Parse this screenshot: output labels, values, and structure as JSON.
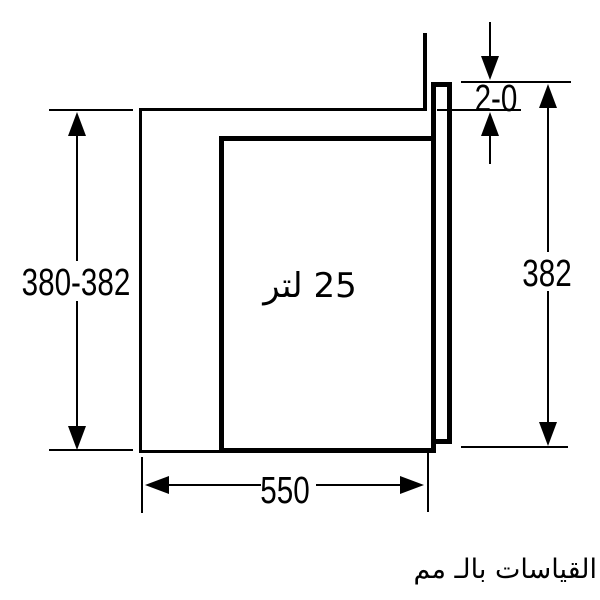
{
  "diagram": {
    "description": "built-in appliance niche side-view dimension drawing",
    "dimensions": {
      "niche_height": "380-382",
      "door_height": "382",
      "top_gap": "2-0",
      "depth": "550"
    },
    "capacity_label": "25 لتر",
    "units_note": "القياسات بالـ مم",
    "colors": {
      "line": "#000000",
      "background": "#ffffff"
    }
  }
}
